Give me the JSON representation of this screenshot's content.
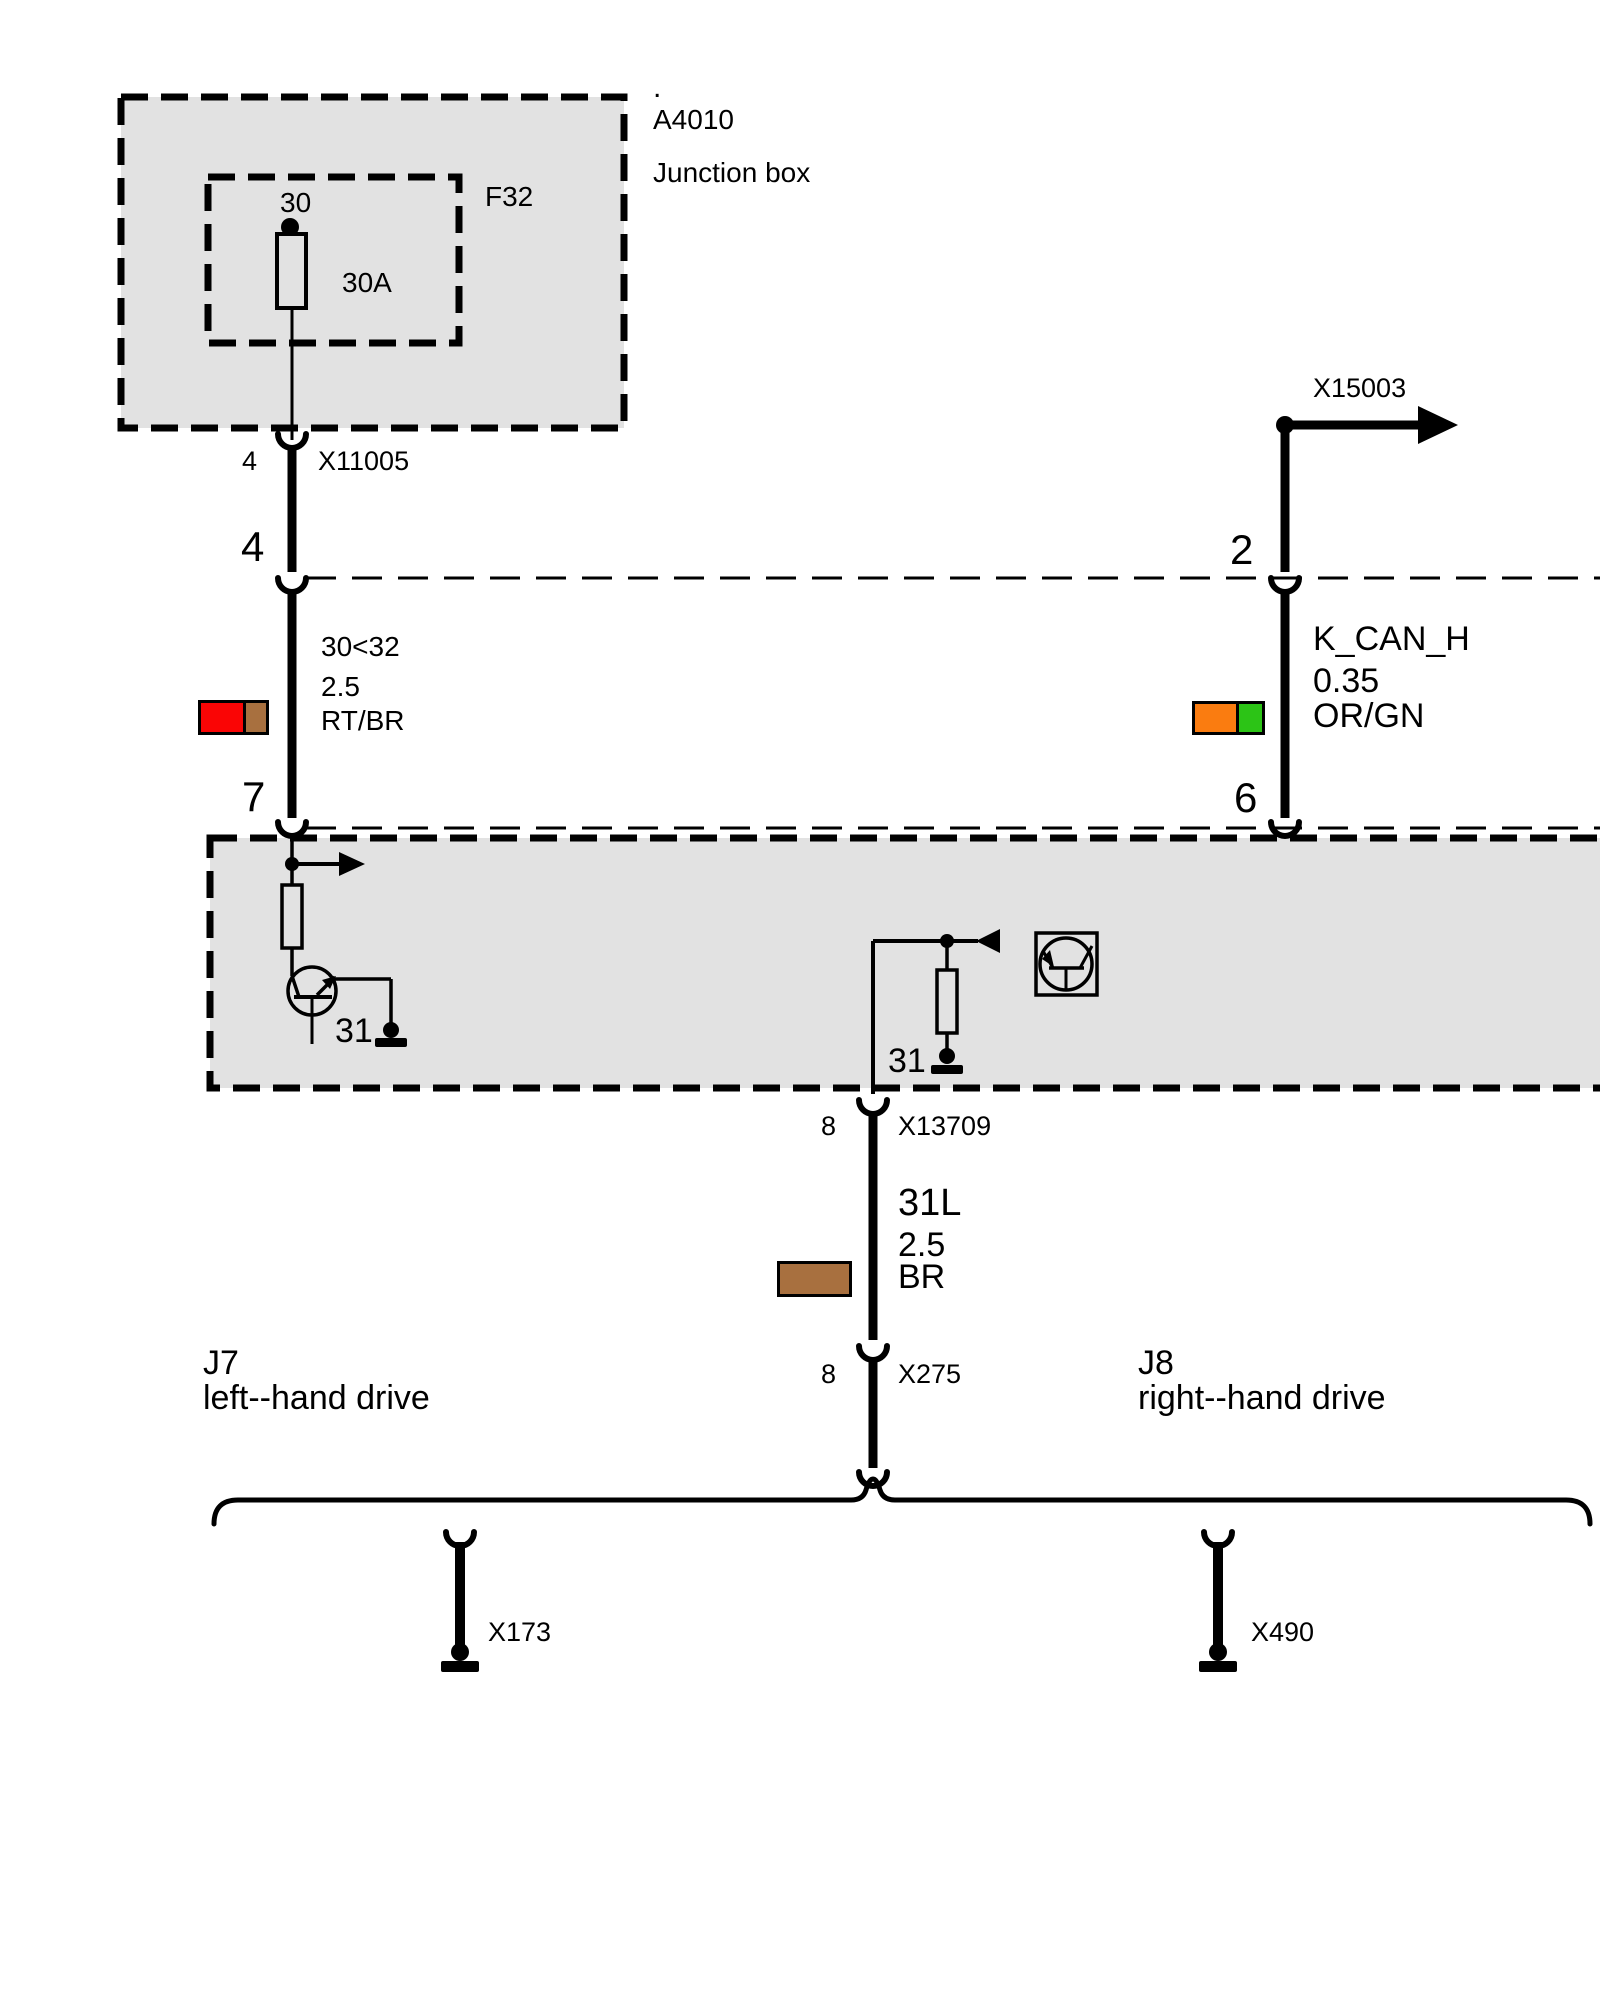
{
  "junction_box": {
    "dot": ".",
    "id": "A4010",
    "name": "Junction box",
    "fuse_id": "F32",
    "fuse_terminal": "30",
    "fuse_rating": "30A"
  },
  "connector_x11005": {
    "pin": "4",
    "label": "X11005"
  },
  "pins": {
    "p4": "4",
    "p7": "7",
    "p2": "2",
    "p6": "6"
  },
  "wire_left": {
    "circuit": "30<32",
    "size": "2.5",
    "code": "RT/BR",
    "color1": "#FA0505",
    "color2": "#A8703F"
  },
  "wire_right": {
    "circuit": "K_CAN_H",
    "size": "0.35",
    "code": "OR/GN",
    "color1": "#FA7C10",
    "color2": "#2CC416"
  },
  "wire_bottom": {
    "circuit": "31L",
    "size": "2.5",
    "code": "BR",
    "color1": "#A8703F"
  },
  "x15003": "X15003",
  "module": {
    "ground_left": "31",
    "ground_right": "31"
  },
  "connector_x13709": {
    "pin": "8",
    "label": "X13709"
  },
  "connector_x275": {
    "pin": "8",
    "label": "X275"
  },
  "variant_left": {
    "code": "J7",
    "label": "left--hand drive"
  },
  "variant_right": {
    "code": "J8",
    "label": "right--hand drive"
  },
  "connector_x173": "X173",
  "connector_x490": "X490",
  "colors": {
    "module_fill": "#E2E2E2",
    "line": "#000000"
  }
}
